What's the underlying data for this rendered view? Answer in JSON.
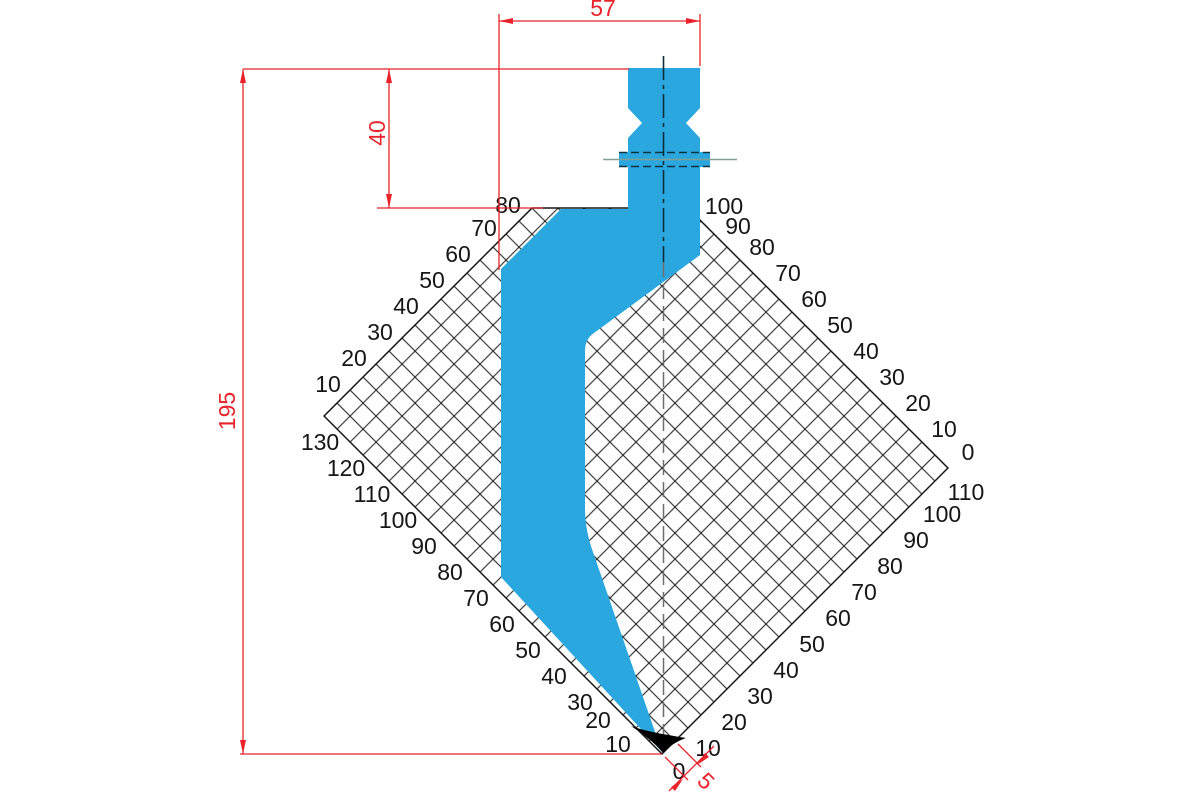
{
  "drawing": {
    "type": "press-brake punch profile with height grid",
    "dims": {
      "width_top": "57",
      "head_height": "40",
      "total_height": "195",
      "tip_flat": "5"
    },
    "origin_label": "0"
  },
  "scales": {
    "upper_left": [
      "10",
      "20",
      "30",
      "40",
      "50",
      "60",
      "70",
      "80"
    ],
    "lower_left": [
      "10",
      "20",
      "30",
      "40",
      "50",
      "60",
      "70",
      "80",
      "90",
      "100",
      "110",
      "120",
      "130"
    ],
    "upper_right": [
      "0",
      "10",
      "20",
      "30",
      "40",
      "50",
      "60",
      "70",
      "80",
      "90",
      "100"
    ],
    "lower_right": [
      "10",
      "20",
      "30",
      "40",
      "50",
      "60",
      "70",
      "80",
      "90",
      "100",
      "110"
    ]
  },
  "colors": {
    "punch_blue": "#2aa7df",
    "dimension_red": "#e8232a",
    "grid_black": "#161616",
    "centerline_gray": "#6e6e6e",
    "groove_teal": "#7fa092",
    "tip_black": "#000000"
  }
}
